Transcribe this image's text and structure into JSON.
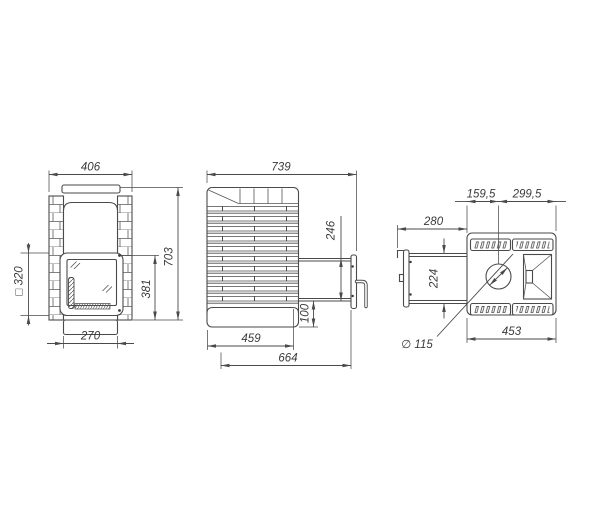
{
  "colors": {
    "background": "#ffffff",
    "line": "#4a4a4a",
    "text": "#3a3a3a"
  },
  "views": {
    "front": {
      "label": "front-view",
      "dims": {
        "overall_width": "406",
        "overall_height": "703",
        "door_height": "381",
        "opening_square": "□ 320",
        "base_width": "270"
      }
    },
    "side": {
      "label": "side-view",
      "dims": {
        "overall_depth": "739",
        "tunnel_height": "246",
        "tunnel_bottom_offset": "100",
        "base_depth": "459",
        "total_depth": "664"
      }
    },
    "top": {
      "label": "top-view",
      "dims": {
        "chimney_to_front": "159,5",
        "chimney_to_back": "299,5",
        "tunnel_length": "280",
        "tunnel_width": "224",
        "chimney_diameter": "∅ 115",
        "body_width": "453"
      }
    }
  }
}
